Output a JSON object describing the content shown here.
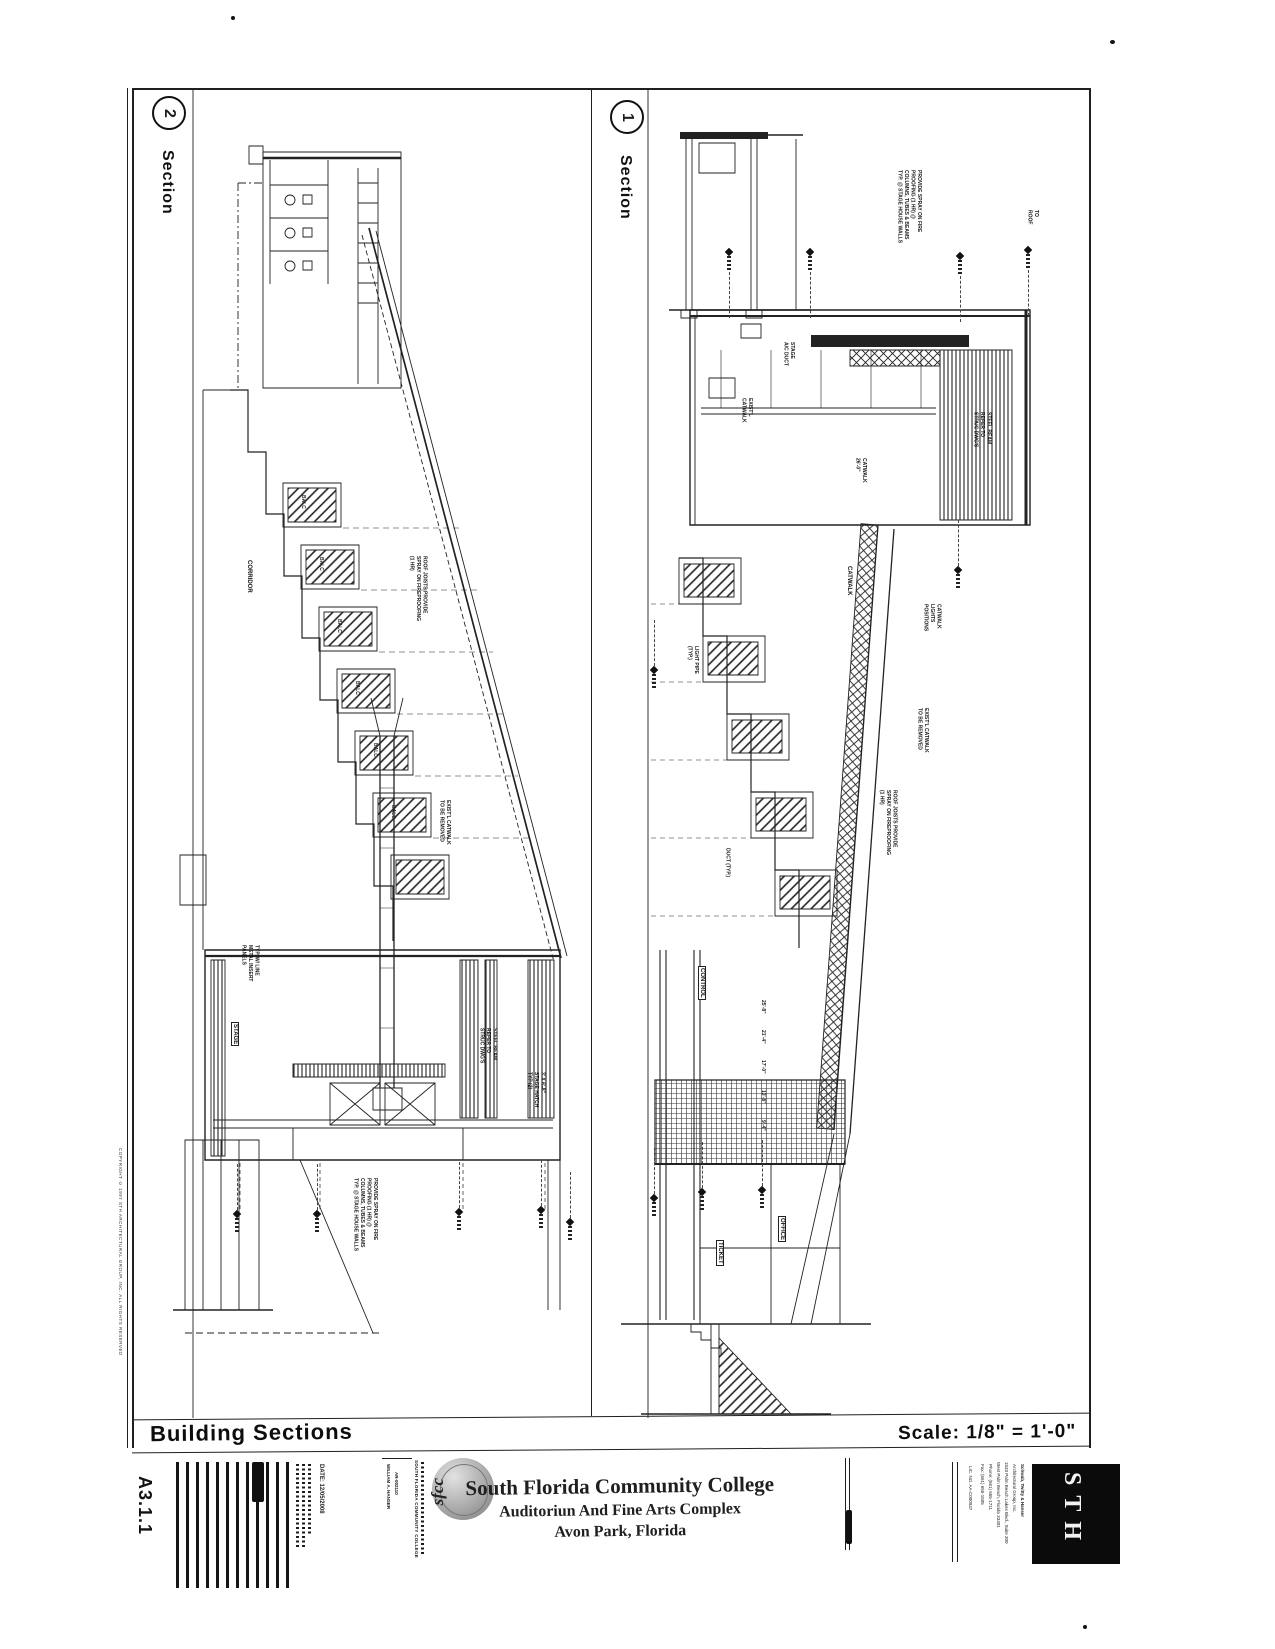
{
  "colors": {
    "ink": "#1f1f1f",
    "paper": "#ffffff",
    "logo_gray": "#9a9a9a"
  },
  "sheet": {
    "title": "Building Sections",
    "scale": "Scale: 1/8\" = 1'-0\"",
    "number": "A3.1.1",
    "date": "DATE: 12/05/2008",
    "copyright": "COPYRIGHT © 1997 STH ARCHITECTURAL GROUP, INC. ALL RIGHTS RESERVED"
  },
  "titleblock": {
    "college": "South Florida Community College",
    "project": "Auditoriun And Fine Arts Complex",
    "location": "Avon Park, Florida",
    "logo_text": "sfcc",
    "campus_line": "SOUTH FLORIDA COMMUNITY COLLEGE",
    "stamp_name": "WILLIAM A. HANSER",
    "stamp_license": "AR-002110",
    "architect_logo": "STH",
    "architect_lines": [
      "Schwab, Twitty & Hanser",
      "Architectural Group, Inc.",
      "1533 Palm Beach Lakes Blvd., Suite 300",
      "West Palm Beach, Florida 33401",
      "Phone: (561) 655-1711",
      "Fax: (561) 655-1505",
      "LIC. NO. AA-C000937"
    ]
  },
  "sections": [
    {
      "num": "2",
      "label": "Section",
      "notes": [
        "ROOF JOISTS PROVIDE\nSPRAY ON FIREPROOFING\n(1 HR)",
        "EXIST'L CATWALK\nTO BE REMOVED",
        "TYP. W/ LINE\nMETAL INSERT\nPANELS",
        "STEEL BEAM\nREFER TO\nSTRUC DWG'S",
        "3' X 6'-8\"\nSTAGE HATCH\nTYP (2)",
        "PROVIDE SPRAY ON FIRE\nPROOFING (1 HR) @\nCOLUMNS, TUBES & BEAMS\nTYP. @ STAGE HOUSE WALLS",
        "CORRIDOR",
        "STAGE"
      ],
      "step_labels": [
        "BALC",
        "BALC",
        "BALC",
        "BALC",
        "BALC",
        "BALC"
      ]
    },
    {
      "num": "1",
      "label": "Section",
      "notes": [
        "PROVIDE SPRAY ON FIRE\nPROOFING (1 HR) @\nCOLUMNS, TUBES & BEAMS\nTYP. @ STAGE HOUSE WALLS",
        "TO\nROOF",
        "STAGE\nA/C DUCT",
        "EXIST'L\nCATWALK",
        "CATWALK\n26'-0\"",
        "STEEL BEAM\nREFER TO\nSTRUC DWG'S",
        "CATWALK\nLIGHTS\nPOSITIONS",
        "EXIST'L CATWALK\nTO BE REMOVED",
        "ROOF JOISTS PROVIDE\nSPRAY ON FIREPROOFING\n(1 HR)",
        "LIGHT PIPE\n(TYP.)",
        "DUCT (TYP.)",
        "CONTROL",
        "OFFICE",
        "TICKET",
        "CATWALK"
      ],
      "dims": [
        "25'-8\"",
        "21'-4\"",
        "17'-0\"",
        "13'-8\"",
        "9'-4\""
      ]
    }
  ]
}
